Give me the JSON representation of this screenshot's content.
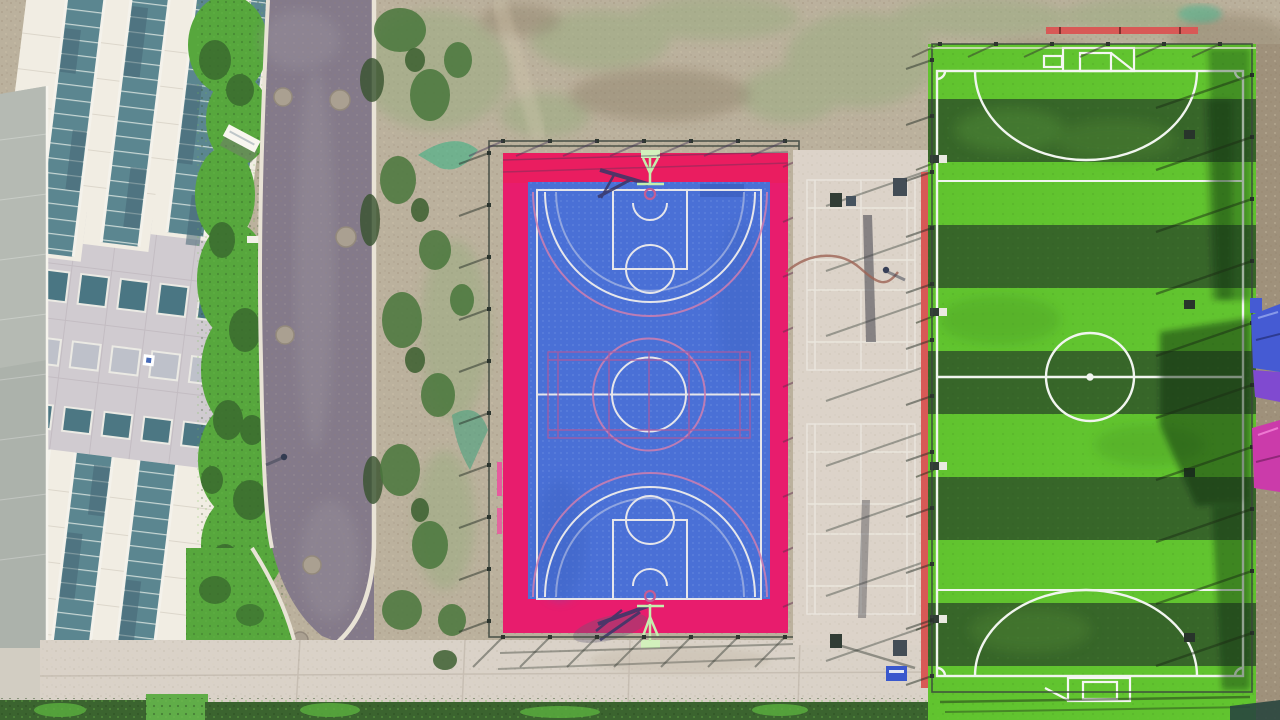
{
  "scene": {
    "type": "aerial-drone-photograph",
    "description": "Top-down drone view of a school sports complex: a blue basketball court with hot-pink surround and badminton overlay inside a fence, a concrete strip with badminton courts, and a striped artificial-turf mini soccer pitch; a panelled office building with vertical glass strips on the left, a dark asphalt road, scrubland, hedges and tarp-covered tents on the right edge.",
    "objects": [
      "building-with-glass-strips",
      "gray-roof-strip",
      "lawn-and-bushes",
      "asphalt-road",
      "manhole-covers",
      "scrub-ground",
      "concrete-apron",
      "basketball-court",
      "court-fence",
      "basketball-hoops",
      "badminton-overlay",
      "concrete-badminton-strip",
      "garden-hose",
      "pedestrians",
      "soccer-field",
      "goals",
      "center-circle",
      "penalty-arcs",
      "field-fence",
      "red-edge-strip",
      "tents",
      "hedge-row",
      "blue-cart"
    ]
  },
  "palette": {
    "dirt": "#b7ab95",
    "dirtDark": "#9a8d78",
    "moss": "#93a878",
    "road": "#7d7284",
    "curb": "#e6dfd2",
    "apron": "#d7cec3",
    "concreteStrip": "#d9cfc4",
    "buildingCream": "#efeadf",
    "buildingBand": "#ccc6cc",
    "glassTeal": "#4f7d88",
    "roofStrip": "#a6ada5",
    "lawn": "#4aa32e",
    "bush": "#2e6322",
    "hedge": "#2f5c22",
    "courtPink": "#ee0e66",
    "courtBlue": "#3e68d8",
    "courtLine": "#e3e2e8",
    "courtLinePink": "#d077ab",
    "badmintonOverlay": "#a6519e",
    "hoopStand": "#bfeca6",
    "hoopRim": "#c2538f",
    "hoopShadow": "#2e2d62",
    "fieldLight": "#55c11e",
    "fieldDark": "#2b5e1c",
    "fieldLine": "#eef3ec",
    "redStrip": "#da4f4b",
    "fence": "#2f3b33",
    "tentBlue": "#3a52d6",
    "tentPurple": "#7a3fd2",
    "tentMagenta": "#cd2ea8",
    "cartBlue": "#2e4fd0",
    "manhole": "#a5998a"
  }
}
